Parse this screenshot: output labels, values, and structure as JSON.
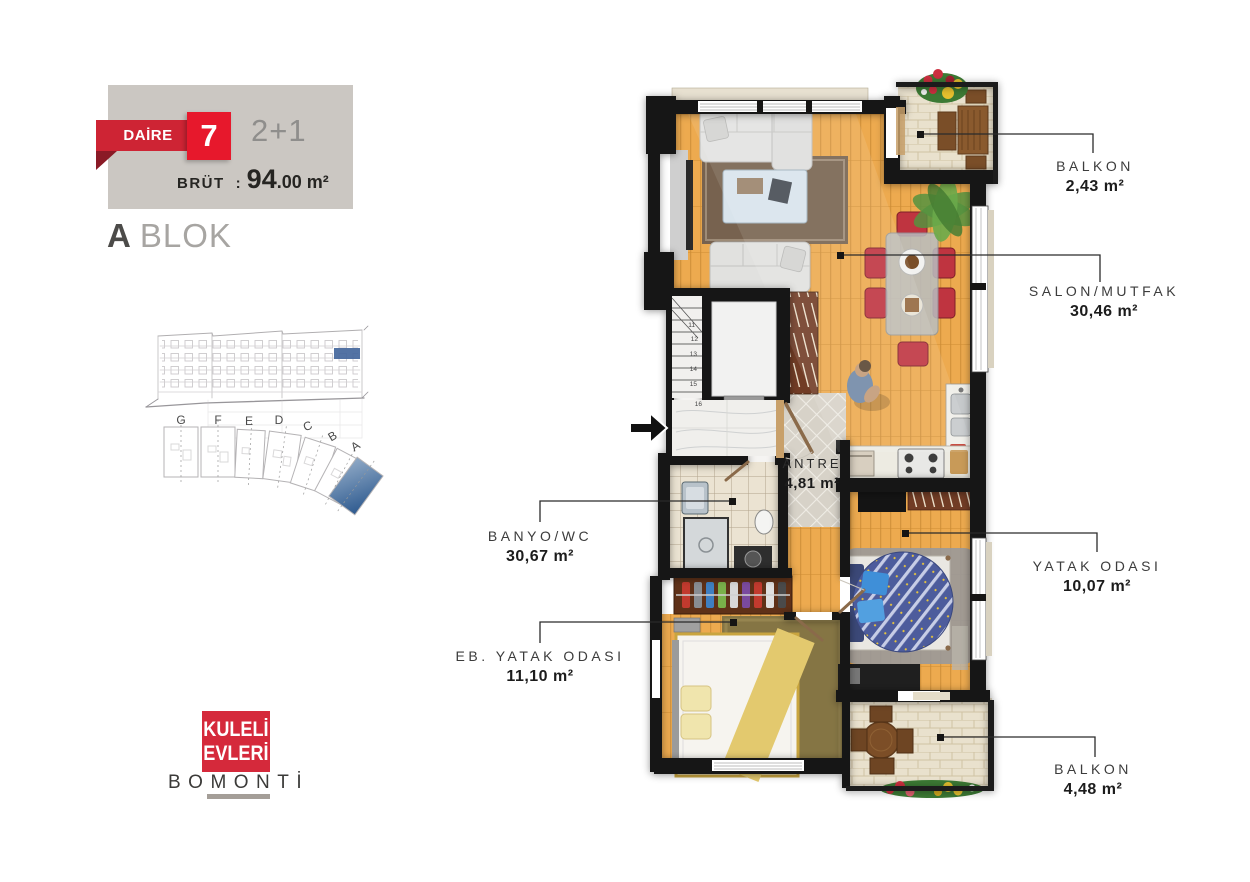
{
  "card": {
    "ribbon_label": "DAİRE",
    "unit_number": "7",
    "room_config": "2+1",
    "gross_label": "BRÜT",
    "gross_colon": ":",
    "gross_area_big": "94",
    "gross_area_small": ".00 m²"
  },
  "block_title": {
    "letter": "A",
    "word": "BLOK"
  },
  "sitemap": {
    "blocks": [
      "G",
      "F",
      "E",
      "D",
      "C",
      "B",
      "A"
    ],
    "highlighted_block": "A"
  },
  "stairs": {
    "numbers": [
      "11",
      "12",
      "13",
      "14",
      "15",
      "16"
    ]
  },
  "rooms": {
    "antre": {
      "name": "ANTRE",
      "area": "4,81 m²"
    },
    "balkon_top": {
      "name": "BALKON",
      "area": "2,43 m²"
    },
    "salon_mutfak": {
      "name": "SALON/MUTFAK",
      "area": "30,46 m²"
    },
    "yatak_odasi": {
      "name": "YATAK ODASI",
      "area": "10,07 m²"
    },
    "balkon_bottom": {
      "name": "BALKON",
      "area": "4,48 m²"
    },
    "banyo_wc": {
      "name": "BANYO/WC",
      "area": "30,67 m²"
    },
    "eb_yatak_odasi": {
      "name": "EB. YATAK ODASI",
      "area": "11,10 m²"
    }
  },
  "logo": {
    "line1": "KULELİ",
    "line2": "EVLERİ",
    "city": "BOMONTİ"
  },
  "colors": {
    "brand_red": "#d5293b",
    "badge_red": "#e7182c",
    "ribbon_red": "#ce2434",
    "card_bg": "#cbc7c2",
    "highlight_blue": "#44679c"
  }
}
